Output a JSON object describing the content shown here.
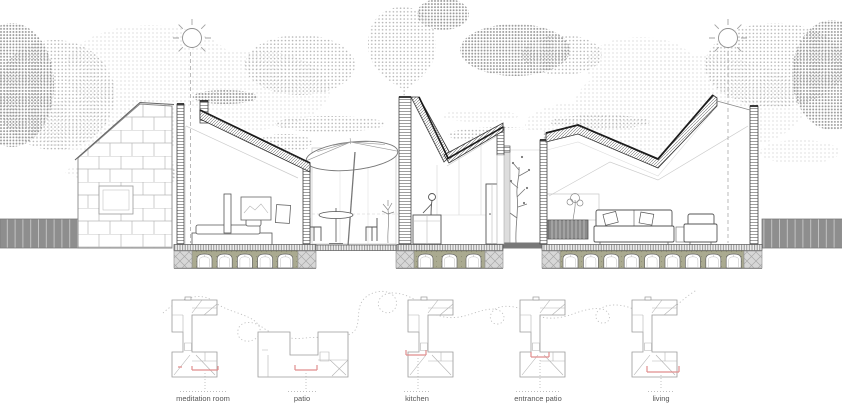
{
  "drawing": {
    "kind": "architectural cross-section with floor-plan key diagrams",
    "sections_visible": [
      "shingled gable elevation",
      "meditation room",
      "patio with umbrella",
      "kitchen",
      "courtyard tree",
      "living room"
    ],
    "plan_note": "dotted walking route threads through five miniature plans; red brackets mark each section cut"
  },
  "plans": [
    {
      "label": "meditation room"
    },
    {
      "label": "patio"
    },
    {
      "label": "kitchen"
    },
    {
      "label": "entrance patio"
    },
    {
      "label": "living"
    }
  ],
  "icons": {
    "sun_left": "sun-icon",
    "sun_right": "sun-icon",
    "clouds": "halftone-cloud",
    "smoke": "chimney-smoke-balloon",
    "umbrella": "patio-umbrella-icon",
    "person": "person-at-counter",
    "tree": "courtyard-tree"
  },
  "colors": {
    "line": "#444444",
    "light_line": "#bbbbbb",
    "fence_gray": "#8e8e8e",
    "foundation_olive": "#aaaa90",
    "block_gray": "#d7d7d7",
    "section_marker_red": "#e08e8e",
    "halftone_light": "#cfcfcf",
    "halftone_mid": "#b4b4b4",
    "halftone_dark": "#969696"
  }
}
